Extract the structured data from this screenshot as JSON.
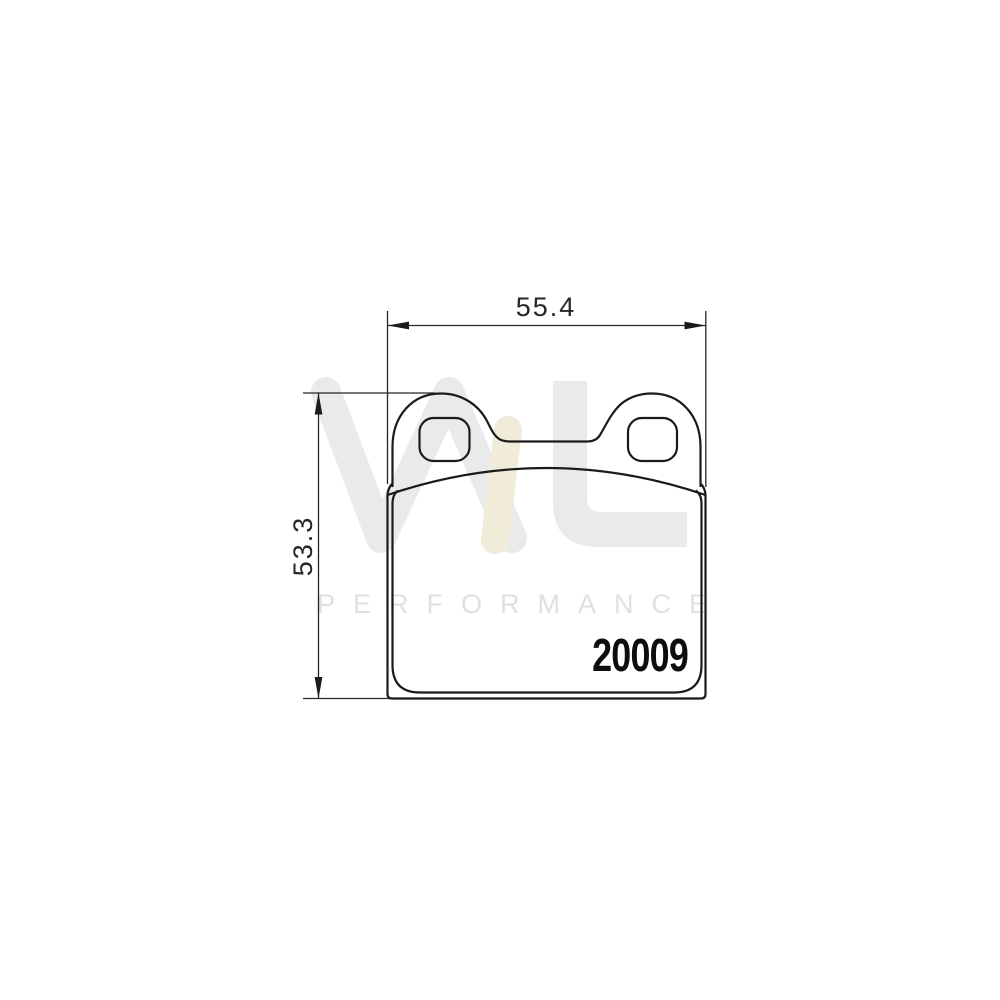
{
  "page": {
    "background_color": "#ffffff"
  },
  "watermark": {
    "brand_letter_m": "M",
    "brand_letter_l": "L",
    "subtitle": "PERFORMANCE",
    "gray_color": "#eaeaea",
    "accent_color": "#f0ecd9",
    "subtitle_color": "#e0e0e0"
  },
  "drawing": {
    "part_number": "20009",
    "width_dimension": "55.4",
    "height_dimension": "53.3",
    "line_color": "#1b1b1b",
    "dimension_color": "#262626"
  }
}
